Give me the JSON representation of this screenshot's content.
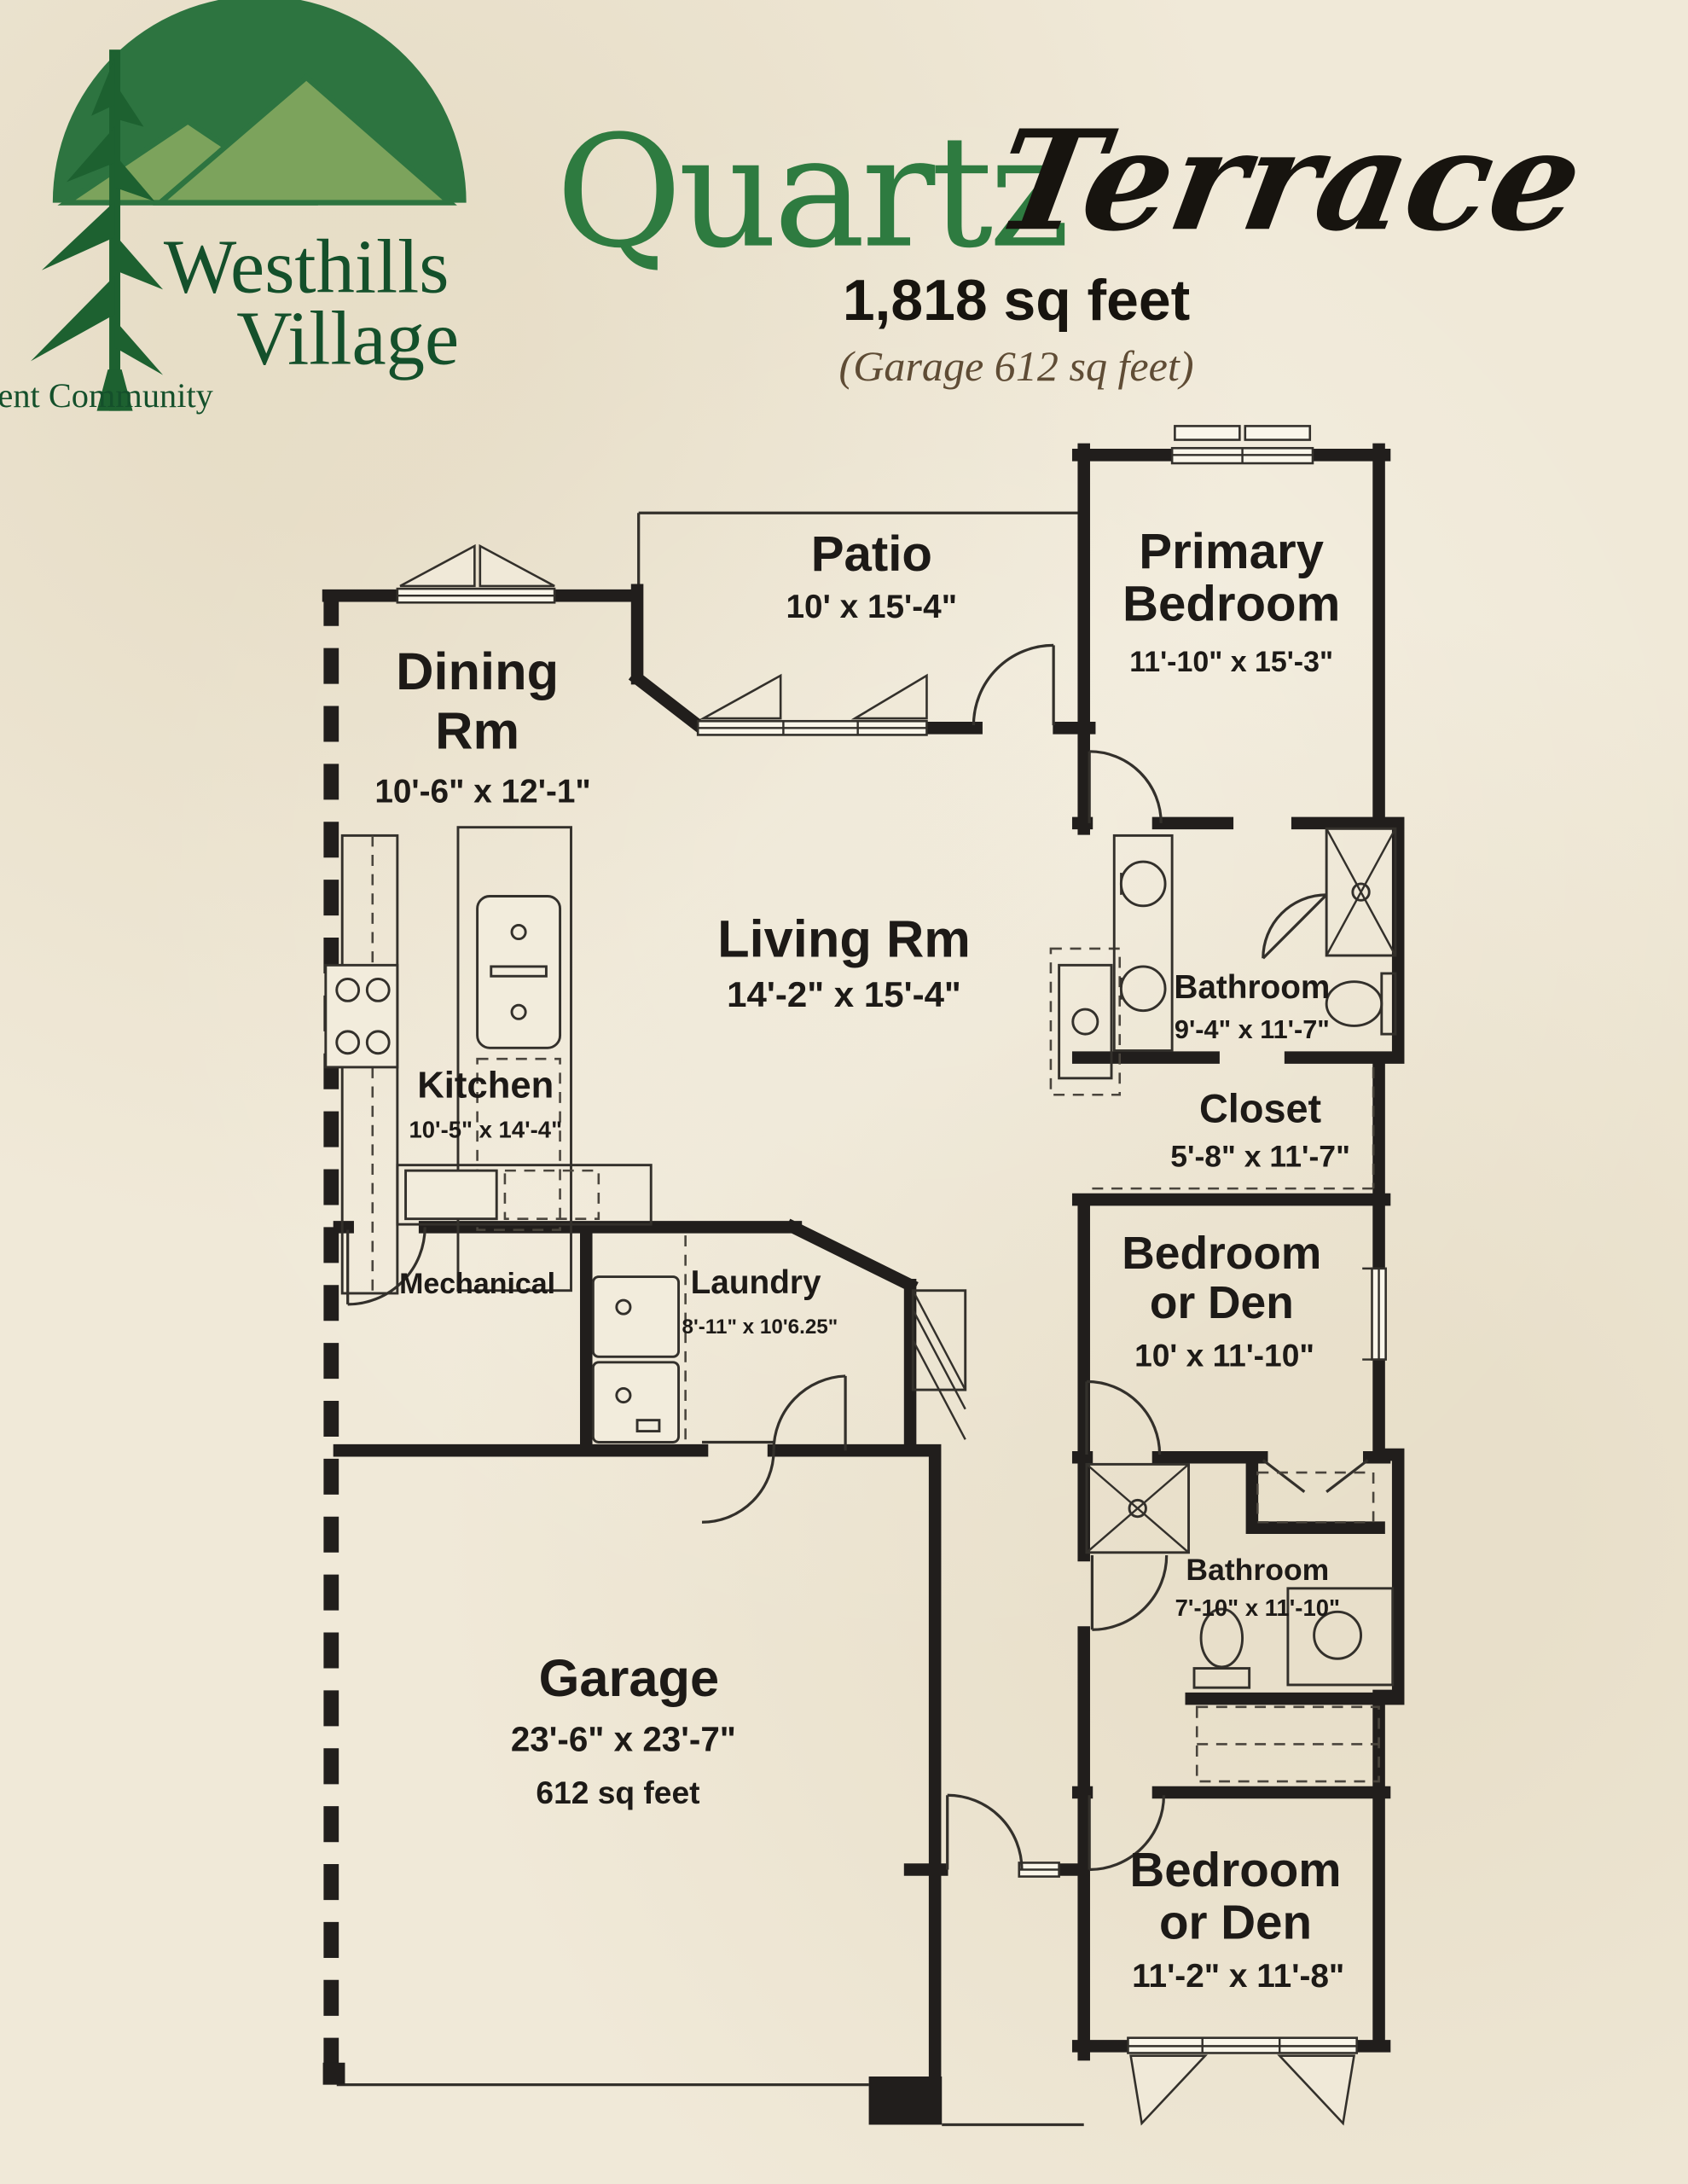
{
  "palette": {
    "parchment": "#f0e9d8",
    "ink": "#211e1c",
    "title_green": "#2e7b40",
    "logo_dome_green": "#2d7440",
    "logo_mountain_green": "#7ca35c",
    "logo_tree_green": "#1d6130",
    "logo_text_green": "#14502b",
    "note_brown": "#5f4c35"
  },
  "brand": {
    "name_line1": "Westhills",
    "name_line2": "Village",
    "tagline": "Retirement Community"
  },
  "header": {
    "title_main": "Quartz",
    "title_script": "Terrace",
    "sqft": "1,818 sq feet",
    "garage_note": "(Garage 612 sq feet)"
  },
  "rooms": [
    {
      "id": "patio",
      "l1": "Patio",
      "dims": "10' x 15'-4\""
    },
    {
      "id": "primary-bedroom",
      "l1": "Primary",
      "l2": "Bedroom",
      "dims": "11'-10\" x 15'-3\""
    },
    {
      "id": "dining-rm",
      "l1": "Dining",
      "l2": "Rm",
      "dims": "10'-6\" x 12'-1\""
    },
    {
      "id": "living-rm",
      "l1": "Living Rm",
      "dims": "14'-2\" x 15'-4\""
    },
    {
      "id": "kitchen",
      "l1": "Kitchen",
      "dims": "10'-5\" x 14'-4\""
    },
    {
      "id": "bathroom-primary",
      "l1": "Bathroom",
      "dims": "9'-4\" x 11'-7\""
    },
    {
      "id": "closet-primary",
      "l1": "Closet",
      "dims": "5'-8\" x 11'-7\""
    },
    {
      "id": "bedroom-or-den-1",
      "l1": "Bedroom",
      "l2": "or Den",
      "dims": "10' x 11'-10\""
    },
    {
      "id": "mechanical",
      "l1": "Mechanical"
    },
    {
      "id": "laundry",
      "l1": "Laundry",
      "dims": "8'-11\" x 10'6.25\""
    },
    {
      "id": "bathroom-2",
      "l1": "Bathroom",
      "dims": "7'-10\" x 11'-10\""
    },
    {
      "id": "garage",
      "l1": "Garage",
      "dims": "23'-6\" x 23'-7\"",
      "area": "612 sq feet"
    },
    {
      "id": "bedroom-or-den-2",
      "l1": "Bedroom",
      "l2": "or Den",
      "dims": "11'-2\" x 11'-8\""
    }
  ]
}
